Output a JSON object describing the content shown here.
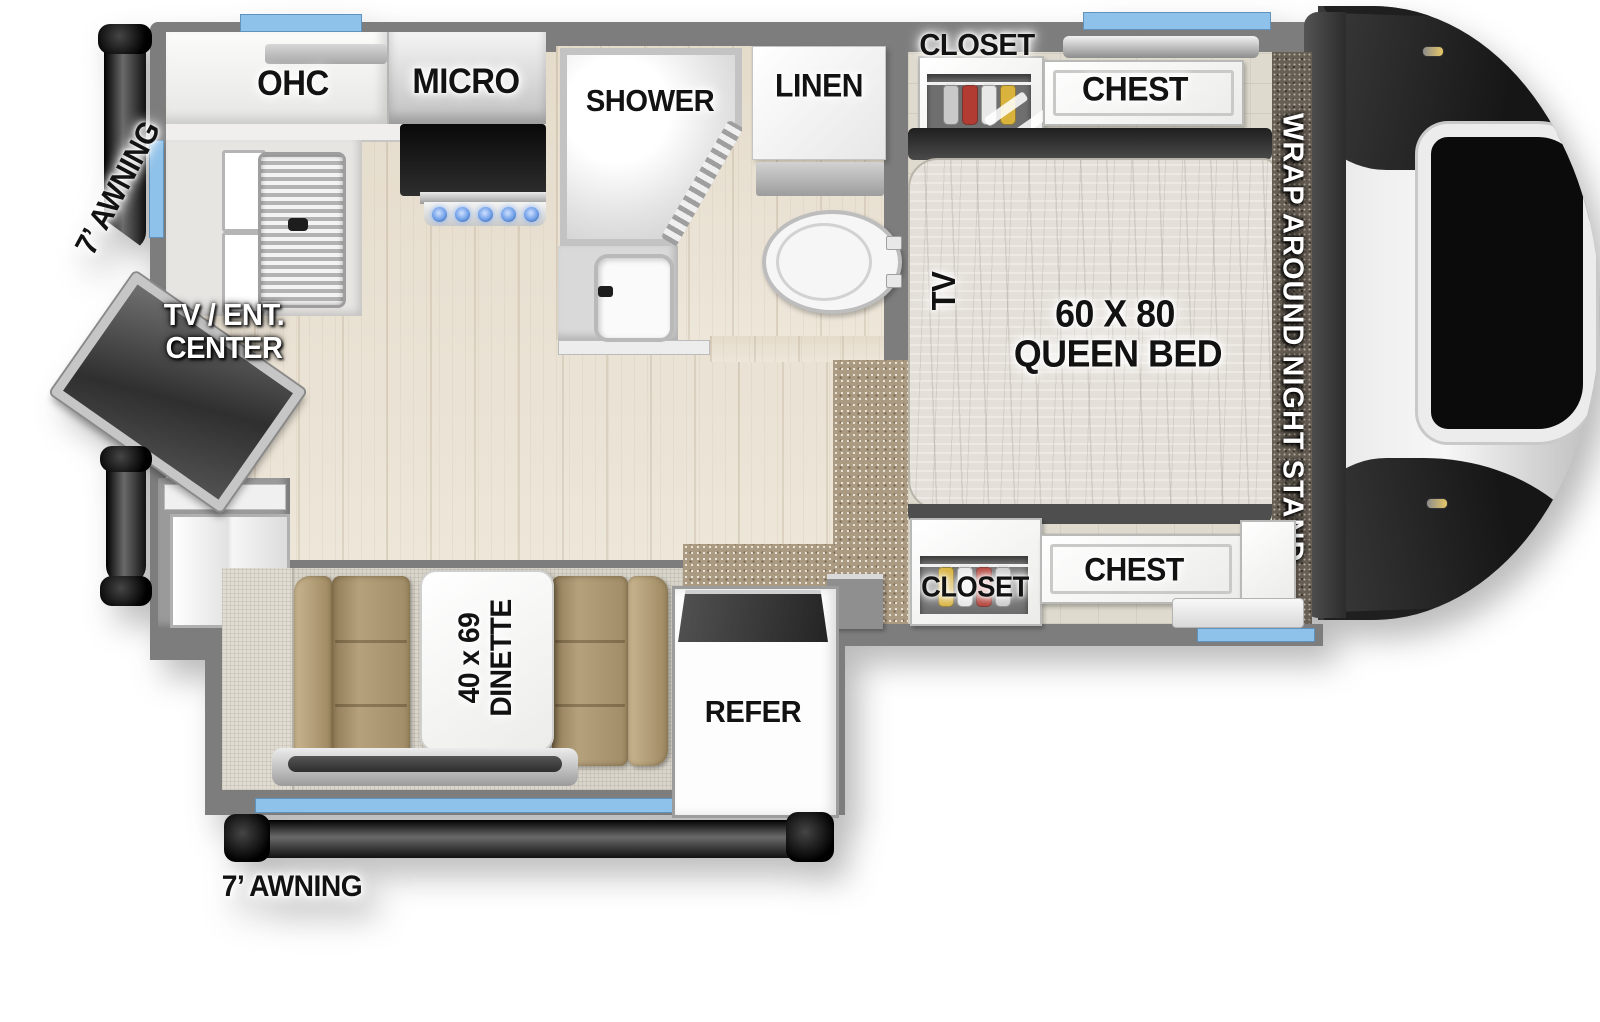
{
  "labels": {
    "awning_left": "7’ AWNING",
    "awning_bottom": "7’ AWNING",
    "ohc": "OHC",
    "micro": "MICRO",
    "shower": "SHOWER",
    "linen": "LINEN",
    "closet_top": "CLOSET",
    "chest_top": "CHEST",
    "tv": "TV",
    "bed_size": "60 X 80",
    "bed_type": "QUEEN BED",
    "night_stand": "WRAP AROUND NIGHT STAND",
    "tv_ent_line1": "TV / ENT.",
    "tv_ent_line2": "CENTER",
    "closet_bottom": "CLOSET",
    "chest_bottom": "CHEST",
    "dinette_size": "40 x 69",
    "dinette_type": "DINETTE",
    "refer": "REFER"
  },
  "closets": {
    "top": [
      "#c9c9c9",
      "#b23b32",
      "#e8e8e8",
      "#d9b33c"
    ],
    "bottom": [
      "#d9b33c",
      "#e8e8e8",
      "#b23b32",
      "#c9c9c9"
    ]
  },
  "colors": {
    "window_accent": "#8fc2ea",
    "wall": "#7d7d7d",
    "wood_floor": "#eae2d3",
    "carpet": "#ab9a82",
    "cushion_tan": "#a28d64",
    "awning_black": "#151515",
    "appliance_white": "#fbfbfb",
    "burner_blue": "#6f9fe8",
    "nose_dark": "#2a2a2a",
    "nose_light": "#f2f2f2"
  }
}
